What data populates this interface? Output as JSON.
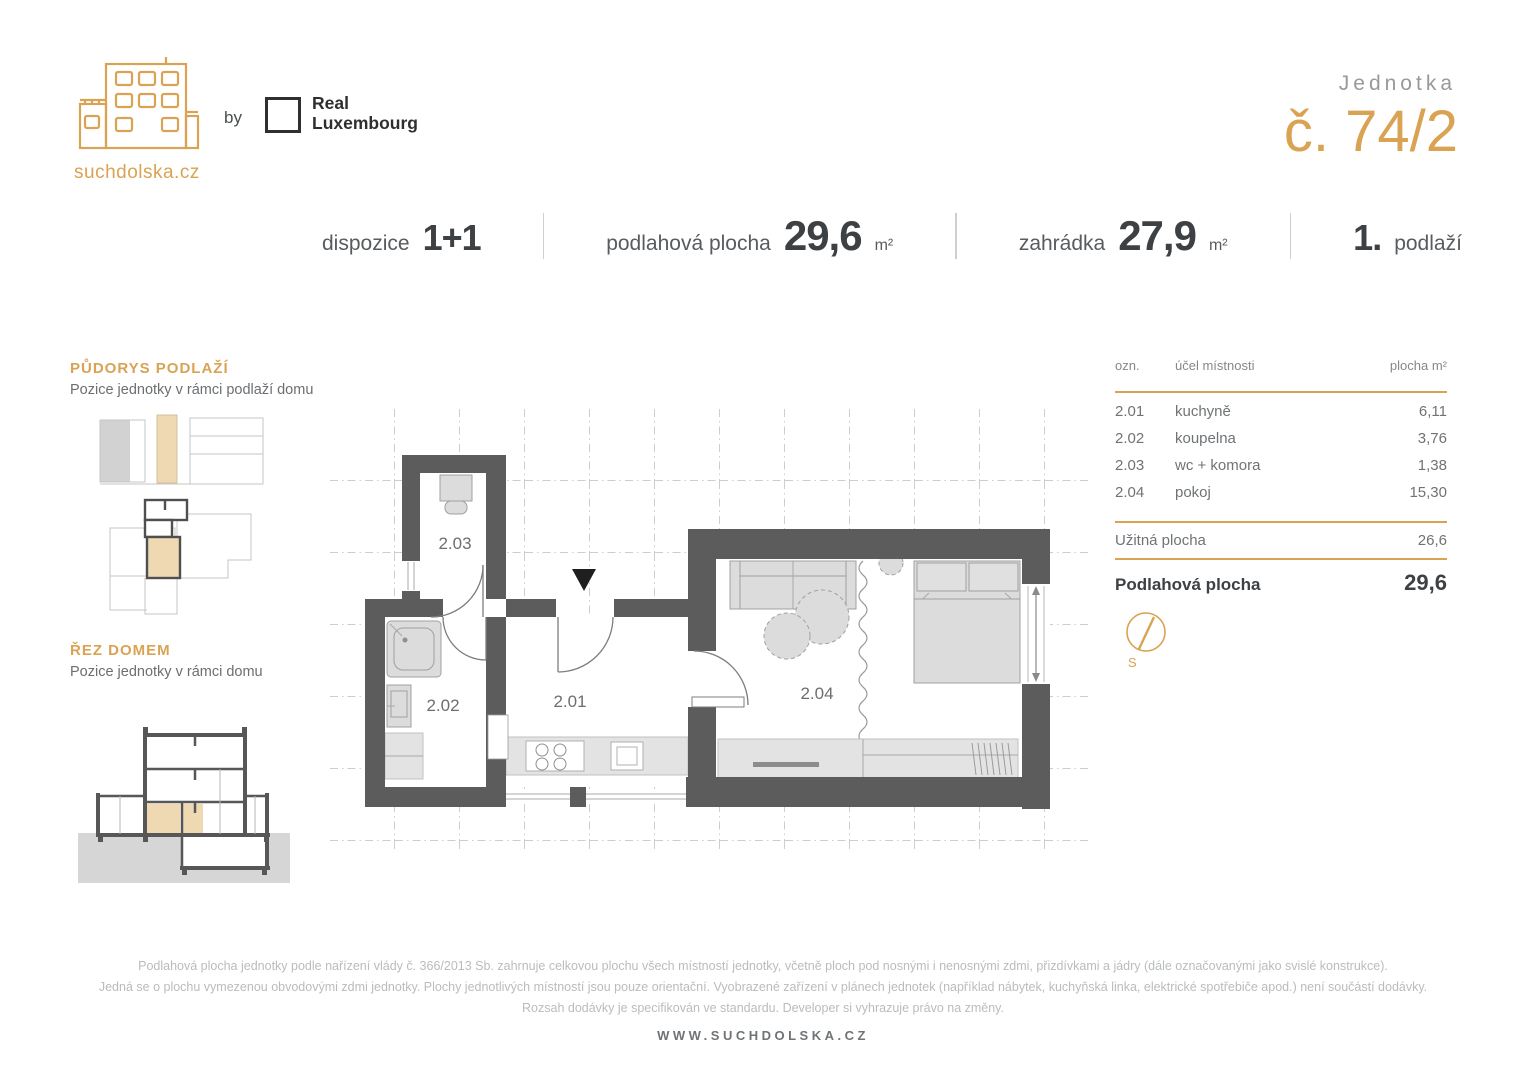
{
  "brand": {
    "logo_text": "suchdolska.cz",
    "by_label": "by",
    "partner_line1": "Real",
    "partner_line2": "Luxembourg"
  },
  "unit": {
    "label": "Jednotka",
    "number": "č. 74/2"
  },
  "specs": {
    "dispozice_label": "dispozice",
    "dispozice_value": "1+1",
    "plocha_label": "podlahová plocha",
    "plocha_value": "29,6",
    "plocha_unit": "m²",
    "zahradka_label": "zahrádka",
    "zahradka_value": "27,9",
    "zahradka_unit": "m²",
    "floor_value": "1.",
    "floor_label": "podlaží"
  },
  "sidebar": {
    "pudorys_title": "PŮDORYS PODLAŽÍ",
    "pudorys_subtitle": "Pozice jednotky v rámci podlaží domu",
    "rez_title": "ŘEZ DOMEM",
    "rez_subtitle": "Pozice jednotky v rámci domu"
  },
  "plan": {
    "rooms": {
      "r201": "2.01",
      "r202": "2.02",
      "r203": "2.03",
      "r204": "2.04"
    },
    "compass_label": "S"
  },
  "table": {
    "headers": {
      "ozn": "ozn.",
      "ucel": "účel místnosti",
      "plocha": "plocha m²"
    },
    "rows": [
      {
        "ozn": "2.01",
        "ucel": "kuchyně",
        "plocha": "6,11"
      },
      {
        "ozn": "2.02",
        "ucel": "koupelna",
        "plocha": "3,76"
      },
      {
        "ozn": "2.03",
        "ucel": "wc + komora",
        "plocha": "1,38"
      },
      {
        "ozn": "2.04",
        "ucel": "pokoj",
        "plocha": "15,30"
      }
    ],
    "uzitna_label": "Užitná plocha",
    "uzitna_value": "26,6",
    "podlahova_label": "Podlahová plocha",
    "podlahova_value": "29,6"
  },
  "footer": {
    "disclaimer_line1": "Podlahová plocha jednotky podle nařízení vlády č. 366/2013 Sb. zahrnuje celkovou plochu všech místností jednotky, včetně ploch pod nosnými i nenosnými zdmi, přizdívkami a jádry (dále označovanými jako svislé konstrukce).",
    "disclaimer_line2": "Jedná se o plochu vymezenou obvodovými zdmi jednotky. Plochy jednotlivých místností jsou pouze orientační. Vyobrazené zařízení v plánech jednotek (například nábytek, kuchyňská linka, elektrické spotřebiče apod.) není součástí dodávky.",
    "disclaimer_line3": "Rozsah dodávky je specifikován ve standardu. Developer si vyhrazuje právo na změny.",
    "website": "WWW.SUCHDOLSKA.CZ"
  },
  "colors": {
    "gold": "#D9A353",
    "dark": "#3D4144",
    "wall": "#5C5C5C",
    "tan": "#EFD9B3",
    "gray": "#6F7376",
    "light": "#D8D8D8"
  }
}
